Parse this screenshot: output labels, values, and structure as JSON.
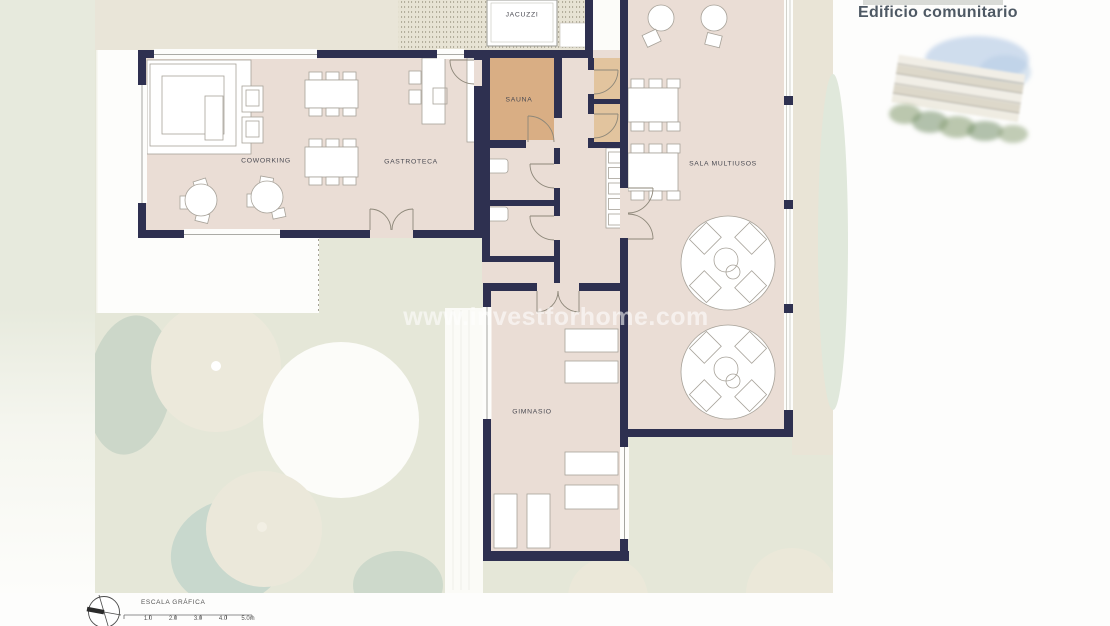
{
  "header": {
    "title": "Edificio comunitario"
  },
  "watermark": "www.investforhome.com",
  "plan": {
    "rooms": {
      "jacuzzi": "JACUZZI",
      "sauna": "SAUNA",
      "coworking": "COWORKING",
      "gastroteca": "GASTROTECA",
      "sala_multiusos": "SALA MULTIUSOS",
      "gimnasio": "GIMNASIO"
    }
  },
  "scale_bar": {
    "label": "ESCALA GRÁFICA",
    "ticks": [
      "1.0",
      "2.0",
      "3.0",
      "4.0",
      "5.0m"
    ]
  },
  "icons": {
    "north_compass": "north-compass-icon",
    "building_illustration": "building-watercolor-illustration"
  },
  "colors": {
    "wall": "#2e3050",
    "floor": "#eaddd5",
    "sauna": "#d9ae84",
    "tan": "#e2c49e",
    "terrace": "#e9e5d8",
    "background": "#e5e7d8",
    "title": "#4e5964",
    "label": "#4a4a52",
    "watermark": "#ffffff"
  }
}
